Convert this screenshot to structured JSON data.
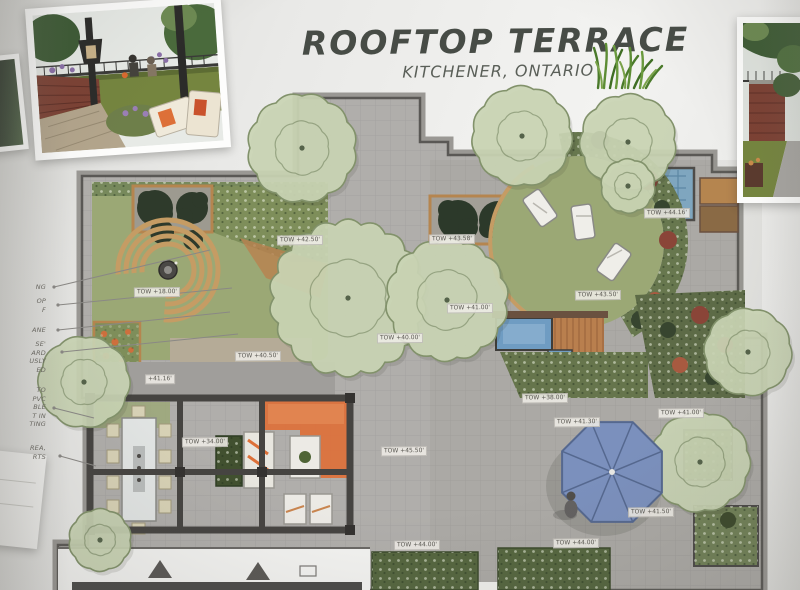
{
  "title": {
    "main": "ROOFTOP TERRACE",
    "location": "KITCHENER, ONTARIO"
  },
  "palette": {
    "paving": "#b0aeab",
    "lawn": "#9ba875",
    "canopy": "#c9d4b4",
    "water": "#6f9cc2",
    "umbrella": "#7b90bd",
    "accent_orange": "#dd7038",
    "bench_wood": "#c59c64",
    "dark_tree": "#2e3a2b",
    "brick": "#7c4134"
  },
  "plan": {
    "tow_labels": [
      {
        "x": 300,
        "y": 240,
        "text": "TOW +42.50'"
      },
      {
        "x": 452,
        "y": 239,
        "text": "TOW +43.58'"
      },
      {
        "x": 157,
        "y": 292,
        "text": "TOW +18.00'"
      },
      {
        "x": 598,
        "y": 295,
        "text": "TOW +43.50'"
      },
      {
        "x": 470,
        "y": 308,
        "text": "TOW +41.00'"
      },
      {
        "x": 667,
        "y": 213,
        "text": "TOW +44.16'"
      },
      {
        "x": 404,
        "y": 451,
        "text": "TOW +45.50'"
      },
      {
        "x": 681,
        "y": 413,
        "text": "TOW +41.00'"
      },
      {
        "x": 651,
        "y": 512,
        "text": "TOW +41.50'"
      },
      {
        "x": 417,
        "y": 545,
        "text": "TOW +44.00'"
      },
      {
        "x": 576,
        "y": 543,
        "text": "TOW +44.00'"
      },
      {
        "x": 258,
        "y": 356,
        "text": "TOW +40.50'"
      },
      {
        "x": 160,
        "y": 379,
        "text": "+41.16'"
      },
      {
        "x": 205,
        "y": 442,
        "text": "TOW +34.00'"
      },
      {
        "x": 400,
        "y": 338,
        "text": "TOW +40.00'"
      },
      {
        "x": 545,
        "y": 398,
        "text": "TOW +38.00'"
      },
      {
        "x": 577,
        "y": 422,
        "text": "TOW +41.30'"
      }
    ]
  },
  "annotations": {
    "blocks": [
      {
        "y": 283,
        "lines": [
          "NG"
        ]
      },
      {
        "y": 297,
        "lines": [
          "OP",
          "F"
        ]
      },
      {
        "y": 326,
        "lines": [
          "ANE"
        ]
      },
      {
        "y": 340,
        "lines": [
          "SE'",
          "ARD",
          "USLY",
          "ED"
        ]
      },
      {
        "y": 386,
        "lines": [
          "TO",
          "PVC",
          "BLE",
          "T IN",
          "TING"
        ]
      },
      {
        "y": 444,
        "lines": [
          "REA,",
          "RTS"
        ]
      }
    ]
  }
}
